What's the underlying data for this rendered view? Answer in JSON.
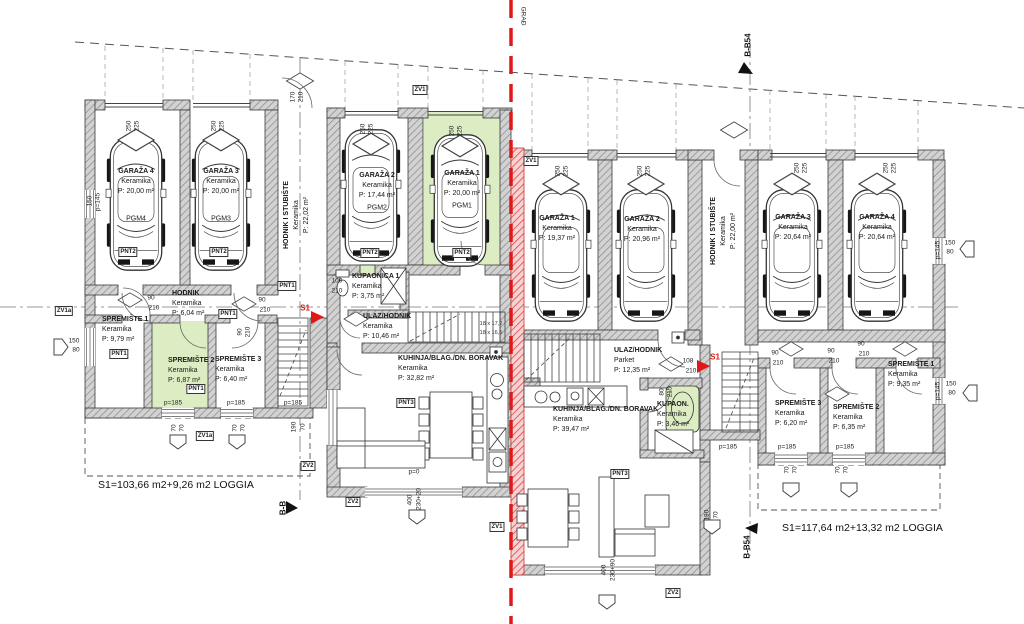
{
  "drawing": {
    "left_unit": {
      "rooms": {
        "garaza4": {
          "name": "GARAŽA 4",
          "material": "Keramika",
          "area": "P: 20,00 m²",
          "spot": "PGM4"
        },
        "garaza3": {
          "name": "GARAŽA 3",
          "material": "Keramika",
          "area": "P: 20,00 m²",
          "spot": "PGM3"
        },
        "garaza2": {
          "name": "GARAŽA 2",
          "material": "Keramika",
          "area": "P: 17,44 m²",
          "spot": "PGM2"
        },
        "garaza1": {
          "name": "GARAŽA 1",
          "material": "Keramika",
          "area": "P: 20,00 m²",
          "spot": "PGM1"
        },
        "hodnik_stubiste": {
          "name": "HODNIK I STUBIŠTE",
          "material": "Keramika",
          "area": "P: 22,02 m²"
        },
        "hodnik": {
          "name": "HODNIK",
          "material": "Keramika",
          "area": "P: 6,04 m²"
        },
        "spremiste1": {
          "name": "SPREMIŠTE 1",
          "material": "Keramika",
          "area": "P: 9,79 m²"
        },
        "spremiste2": {
          "name": "SPREMIŠTE 2",
          "material": "Keramika",
          "area": "P: 6,87 m²"
        },
        "spremiste3": {
          "name": "SPREMIŠTE 3",
          "material": "Keramika",
          "area": "P: 6,40 m²"
        },
        "kupaonica1": {
          "name": "KUPAONICA 1",
          "material": "Keramika",
          "area": "P: 3,75 m²"
        },
        "ulaz_hodnik": {
          "name": "ULAZ/HODNIK",
          "material": "Keramika",
          "area": "P: 10,46 m²"
        },
        "kuhinja": {
          "name": "KUHINJA/BLAG./DN. BORAVAK",
          "material": "Keramika",
          "area": "P: 32,82 m²"
        }
      },
      "summary": "S1=103,66 m2+9,26 m2 LOGGIA"
    },
    "right_unit": {
      "rooms": {
        "garaza1": {
          "name": "GARAŽA 1",
          "material": "Keramika",
          "area": "P: 19,37 m²"
        },
        "garaza2": {
          "name": "GARAŽA 2",
          "material": "Keramika",
          "area": "P: 20,96 m²"
        },
        "garaza3": {
          "name": "GARAŽA 3",
          "material": "Keramika",
          "area": "P: 20,64 m²"
        },
        "garaza4": {
          "name": "GARAŽA 4",
          "material": "Keramika",
          "area": "P: 20,64 m²"
        },
        "hodnik_stubiste": {
          "name": "HODNIK I STUBIŠTE",
          "material": "Keramika",
          "area": "P: 22,00 m²"
        },
        "ulaz_hodnik": {
          "name": "ULAZ/HODNIK",
          "material": "Parket",
          "area": "P: 12,35 m²"
        },
        "kuhinja": {
          "name": "KUHINJA/BLAG./DN. BORAVAK",
          "material": "Keramika",
          "area": "P: 39,47 m²"
        },
        "kupaonica": {
          "name": "KUPAON.",
          "material": "Keramika",
          "area": "P: 3,46 m²"
        },
        "spremiste3": {
          "name": "SPREMIŠTE 3",
          "material": "Keramika",
          "area": "P: 6,20 m²"
        },
        "spremiste2": {
          "name": "SPREMIŠTE 2",
          "material": "Keramika",
          "area": "P: 6,35 m²"
        },
        "spremiste1": {
          "name": "SPREMIŠTE 1",
          "material": "Keramika",
          "area": "P: 9,35 m²"
        }
      },
      "summary": "S1=117,64 m2+13,32 m2 LOGGIA"
    },
    "colors": {
      "highlight": "#dcedc3",
      "section_line": "#e01818",
      "wall_outline": "#3a3a3a"
    },
    "annotations": [
      {
        "t": "250",
        "x": 129,
        "y": 126,
        "r": -90
      },
      {
        "t": "225",
        "x": 137,
        "y": 126,
        "r": -90
      },
      {
        "t": "250",
        "x": 214,
        "y": 126,
        "r": -90
      },
      {
        "t": "225",
        "x": 222,
        "y": 126,
        "r": -90
      },
      {
        "t": "250",
        "x": 363,
        "y": 129,
        "r": -90
      },
      {
        "t": "225",
        "x": 371,
        "y": 129,
        "r": -90
      },
      {
        "t": "250",
        "x": 452,
        "y": 131,
        "r": -90
      },
      {
        "t": "225",
        "x": 460,
        "y": 131,
        "r": -90
      },
      {
        "t": "250",
        "x": 558,
        "y": 171,
        "r": -90
      },
      {
        "t": "225",
        "x": 566,
        "y": 171,
        "r": -90
      },
      {
        "t": "250",
        "x": 640,
        "y": 171,
        "r": -90
      },
      {
        "t": "225",
        "x": 648,
        "y": 171,
        "r": -90
      },
      {
        "t": "250",
        "x": 797,
        "y": 168,
        "r": -90
      },
      {
        "t": "225",
        "x": 805,
        "y": 168,
        "r": -90
      },
      {
        "t": "250",
        "x": 886,
        "y": 168,
        "r": -90
      },
      {
        "t": "225",
        "x": 894,
        "y": 168,
        "r": -90
      },
      {
        "t": "170",
        "x": 293,
        "y": 97,
        "r": -90
      },
      {
        "t": "210",
        "x": 301,
        "y": 97,
        "r": -90
      },
      {
        "t": "90",
        "x": 151,
        "y": 298
      },
      {
        "t": "210",
        "x": 154,
        "y": 308
      },
      {
        "t": "90",
        "x": 262,
        "y": 300
      },
      {
        "t": "210",
        "x": 265,
        "y": 310
      },
      {
        "t": "90",
        "x": 240,
        "y": 332,
        "r": -90
      },
      {
        "t": "210",
        "x": 248,
        "y": 332,
        "r": -90
      },
      {
        "t": "100",
        "x": 337,
        "y": 281
      },
      {
        "t": "210",
        "x": 337,
        "y": 291
      },
      {
        "t": "90",
        "x": 775,
        "y": 353
      },
      {
        "t": "210",
        "x": 778,
        "y": 363
      },
      {
        "t": "90",
        "x": 831,
        "y": 351
      },
      {
        "t": "210",
        "x": 834,
        "y": 361
      },
      {
        "t": "90",
        "x": 861,
        "y": 344
      },
      {
        "t": "210",
        "x": 864,
        "y": 354
      },
      {
        "t": "108",
        "x": 688,
        "y": 361
      },
      {
        "t": "210",
        "x": 691,
        "y": 371
      },
      {
        "t": "80",
        "x": 662,
        "y": 392,
        "r": -90
      },
      {
        "t": "215",
        "x": 670,
        "y": 392,
        "r": -90
      },
      {
        "t": "p=185",
        "x": 173,
        "y": 403
      },
      {
        "t": "p=185",
        "x": 236,
        "y": 403
      },
      {
        "t": "p=185",
        "x": 293,
        "y": 403
      },
      {
        "t": "p=185",
        "x": 728,
        "y": 447
      },
      {
        "t": "p=185",
        "x": 787,
        "y": 447
      },
      {
        "t": "p=185",
        "x": 845,
        "y": 447
      },
      {
        "t": "p=0",
        "x": 414,
        "y": 472
      },
      {
        "t": "400",
        "x": 410,
        "y": 500,
        "r": -90
      },
      {
        "t": "230+20",
        "x": 419,
        "y": 499,
        "r": -90
      },
      {
        "t": "400",
        "x": 604,
        "y": 570,
        "r": -90
      },
      {
        "t": "230+90",
        "x": 613,
        "y": 570,
        "r": -90
      },
      {
        "t": "70",
        "x": 174,
        "y": 428,
        "r": -90
      },
      {
        "t": "70",
        "x": 182,
        "y": 428,
        "r": -90
      },
      {
        "t": "70",
        "x": 235,
        "y": 428,
        "r": -90
      },
      {
        "t": "70",
        "x": 243,
        "y": 428,
        "r": -90
      },
      {
        "t": "190",
        "x": 294,
        "y": 427,
        "r": -90
      },
      {
        "t": "70",
        "x": 303,
        "y": 427,
        "r": -90
      },
      {
        "t": "70",
        "x": 787,
        "y": 470,
        "r": -90
      },
      {
        "t": "70",
        "x": 795,
        "y": 470,
        "r": -90
      },
      {
        "t": "70",
        "x": 838,
        "y": 470,
        "r": -90
      },
      {
        "t": "70",
        "x": 846,
        "y": 470,
        "r": -90
      },
      {
        "t": "190",
        "x": 707,
        "y": 515,
        "r": -90
      },
      {
        "t": "70",
        "x": 716,
        "y": 515,
        "r": -90
      },
      {
        "t": "150",
        "x": 74,
        "y": 341
      },
      {
        "t": "80",
        "x": 76,
        "y": 350
      },
      {
        "t": "150",
        "x": 90,
        "y": 201,
        "r": -90
      },
      {
        "t": "p=145",
        "x": 98,
        "y": 202,
        "r": -90
      },
      {
        "t": "p=145",
        "x": 938,
        "y": 250,
        "r": -90
      },
      {
        "t": "150",
        "x": 950,
        "y": 243
      },
      {
        "t": "80",
        "x": 950,
        "y": 252
      },
      {
        "t": "p=145",
        "x": 938,
        "y": 391,
        "r": -90
      },
      {
        "t": "150",
        "x": 951,
        "y": 384
      },
      {
        "t": "80",
        "x": 952,
        "y": 393
      },
      {
        "t": "18 x 17,2",
        "x": 491,
        "y": 324,
        "c": "tiny"
      },
      {
        "t": "18 x 16,5",
        "x": 491,
        "y": 333,
        "c": "tiny"
      },
      {
        "t": "PNT2",
        "x": 128,
        "y": 252,
        "c": "badge"
      },
      {
        "t": "PNT2",
        "x": 219,
        "y": 252,
        "c": "badge"
      },
      {
        "t": "PNT2",
        "x": 370,
        "y": 253,
        "c": "badge"
      },
      {
        "t": "PNT2",
        "x": 462,
        "y": 253,
        "c": "badge"
      },
      {
        "t": "PNT1",
        "x": 287,
        "y": 286,
        "c": "badge"
      },
      {
        "t": "PNT1",
        "x": 228,
        "y": 314,
        "c": "badge"
      },
      {
        "t": "PNT1",
        "x": 119,
        "y": 354,
        "c": "badge"
      },
      {
        "t": "PNT1",
        "x": 196,
        "y": 389,
        "c": "badge"
      },
      {
        "t": "PNT3",
        "x": 406,
        "y": 403,
        "c": "badge"
      },
      {
        "t": "PNT3",
        "x": 620,
        "y": 474,
        "c": "badge"
      },
      {
        "t": "ZV1",
        "x": 420,
        "y": 90,
        "c": "badge"
      },
      {
        "t": "ZV1",
        "x": 531,
        "y": 161,
        "c": "badge"
      },
      {
        "t": "ZV1",
        "x": 497,
        "y": 527,
        "c": "badge"
      },
      {
        "t": "ZV1a",
        "x": 64,
        "y": 311,
        "c": "badge"
      },
      {
        "t": "ZV1a",
        "x": 205,
        "y": 436,
        "c": "badge"
      },
      {
        "t": "ZV2",
        "x": 308,
        "y": 466,
        "c": "badge"
      },
      {
        "t": "ZV2",
        "x": 353,
        "y": 502,
        "c": "badge"
      },
      {
        "t": "ZV2",
        "x": 673,
        "y": 593,
        "c": "badge"
      },
      {
        "t": "B-B54",
        "x": 748,
        "y": 45,
        "r": -90,
        "c": "sec"
      },
      {
        "t": "B-B54",
        "x": 747,
        "y": 547,
        "r": -90,
        "c": "sec"
      },
      {
        "t": "B-B",
        "x": 283,
        "y": 508,
        "r": -90,
        "c": "sec"
      },
      {
        "t": "S1",
        "x": 305,
        "y": 308,
        "c": "red"
      },
      {
        "t": "S1",
        "x": 715,
        "y": 357,
        "c": "red"
      },
      {
        "t": "GRAĐ",
        "x": 523,
        "y": 16,
        "r": 90
      }
    ]
  }
}
